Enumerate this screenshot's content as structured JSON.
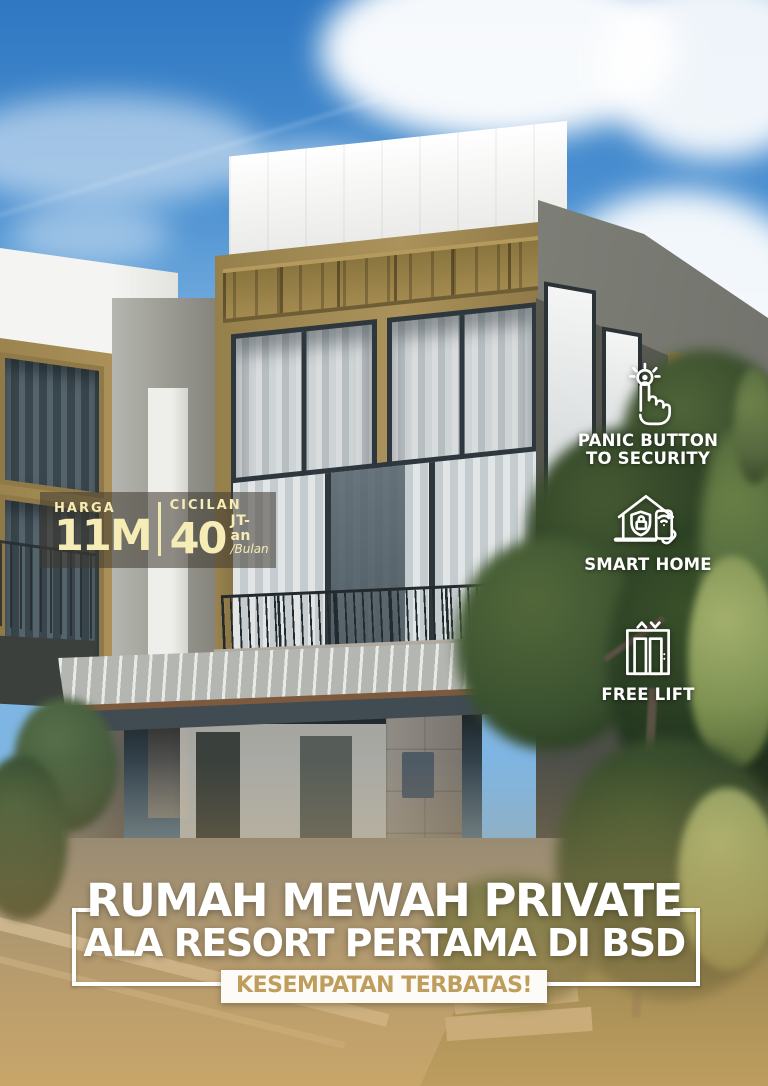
{
  "poster": {
    "price_badge": {
      "harga_label": "HARGA",
      "harga_value": "11M",
      "cicilan_label": "CICILAN",
      "cicilan_value": "40",
      "cicilan_unit": "JT-an",
      "cicilan_per": "/Bulan"
    },
    "features": [
      {
        "icon": "panic-button-icon",
        "line1": "PANIC BUTTON",
        "line2": "TO SECURITY"
      },
      {
        "icon": "smart-home-icon",
        "line1": "SMART HOME",
        "line2": ""
      },
      {
        "icon": "free-lift-icon",
        "line1": "FREE LIFT",
        "line2": ""
      }
    ],
    "headline": {
      "line1": "RUMAH MEWAH PRIVATE",
      "line2": "ALA RESORT PERTAMA DI BSD",
      "badge": "KESEMPATAN TERBATAS!"
    },
    "colors": {
      "cream_text": "#f5ecb6",
      "badge_gold_text": "#bf9d5c",
      "headline_white": "#ffffff",
      "overlay_dark": "rgba(62,56,47,0.55)",
      "facade_gold": "#a18a52",
      "sky_blue": "#4a8fd0"
    }
  }
}
